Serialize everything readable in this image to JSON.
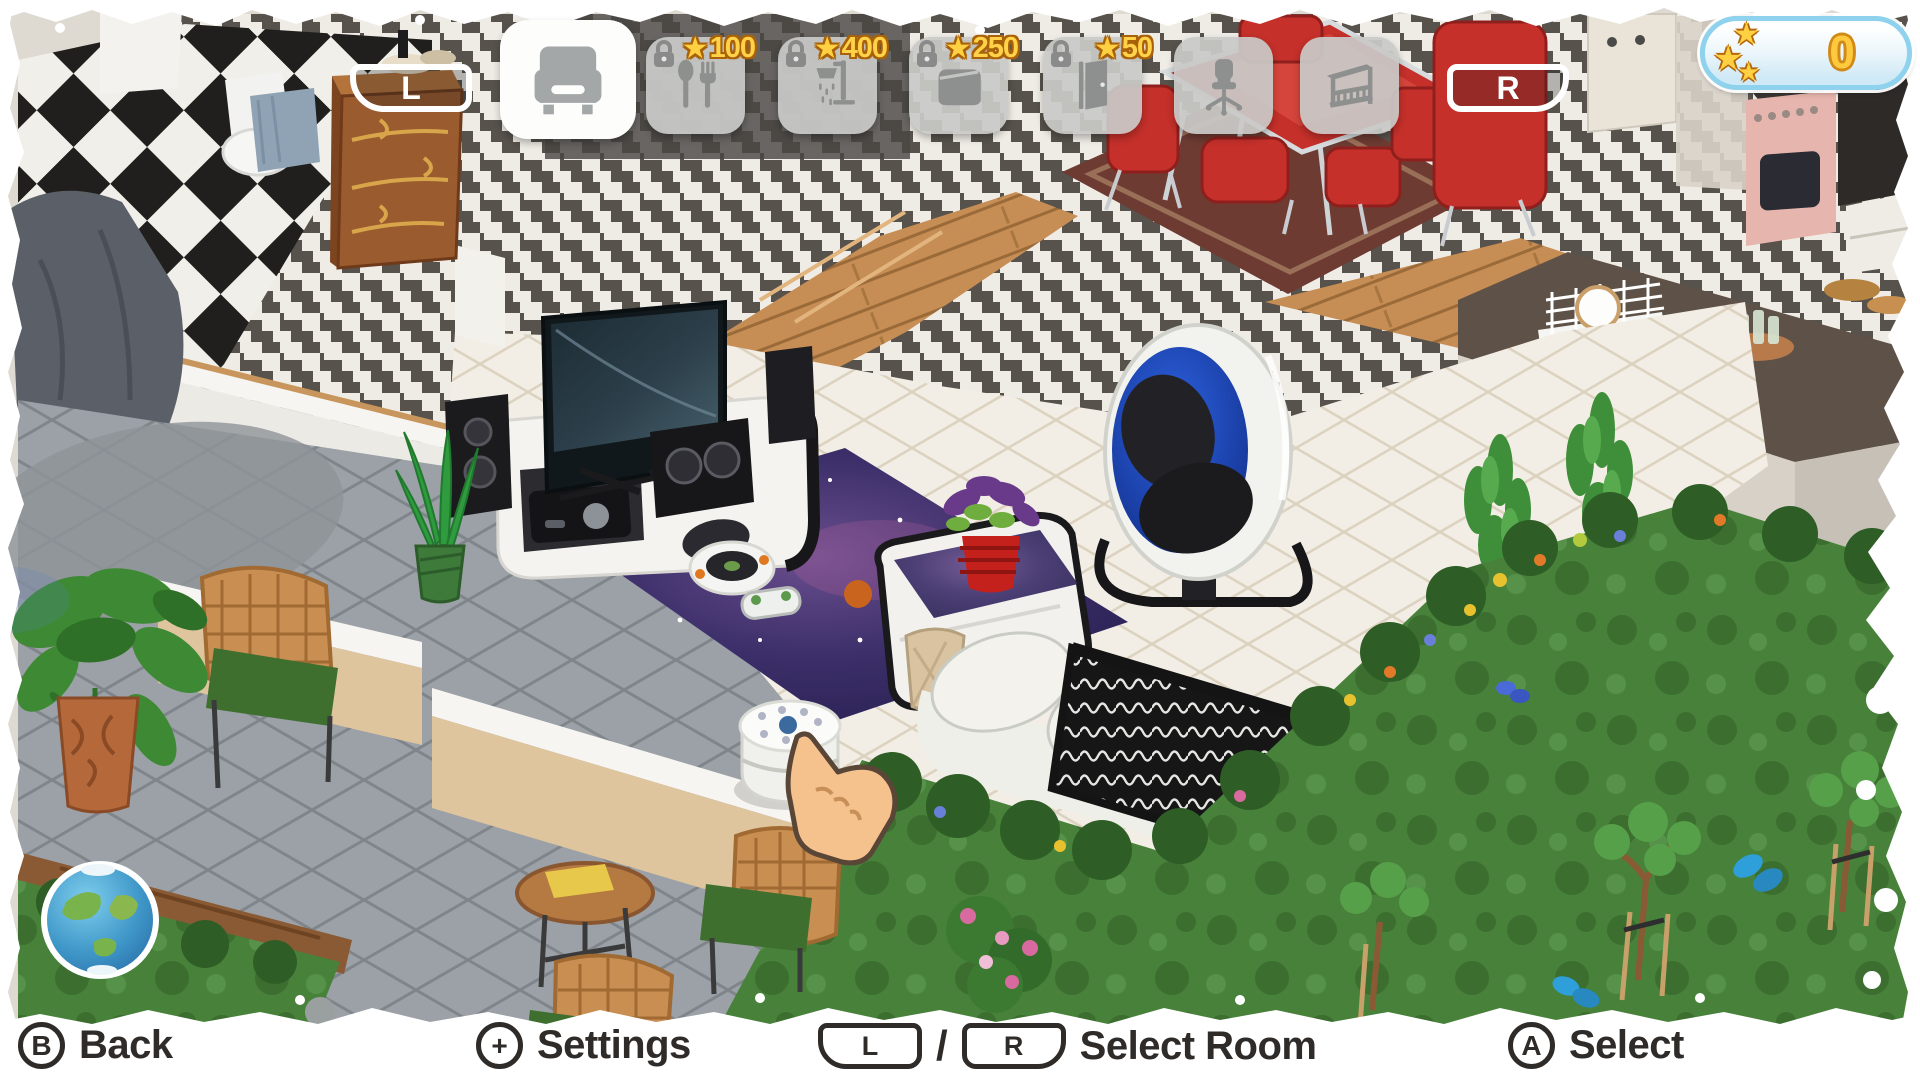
{
  "hud": {
    "left_shoulder": "L",
    "right_shoulder": "R",
    "star_balance": "0",
    "tabs": [
      {
        "name": "living-room",
        "icon": "armchair-icon",
        "selected": true,
        "locked": false,
        "cost": ""
      },
      {
        "name": "dining-room",
        "icon": "cutlery-icon",
        "selected": false,
        "locked": true,
        "cost": "100"
      },
      {
        "name": "bathroom",
        "icon": "shower-icon",
        "selected": false,
        "locked": true,
        "cost": "400"
      },
      {
        "name": "bedroom",
        "icon": "bed-icon",
        "selected": false,
        "locked": true,
        "cost": "250"
      },
      {
        "name": "hallway",
        "icon": "door-icon",
        "selected": false,
        "locked": true,
        "cost": "50"
      },
      {
        "name": "office",
        "icon": "office-chair-icon",
        "selected": false,
        "locked": false,
        "cost": ""
      },
      {
        "name": "balcony",
        "icon": "balcony-icon",
        "selected": false,
        "locked": false,
        "cost": ""
      }
    ]
  },
  "bottom_bar": {
    "back": {
      "button": "B",
      "label": "Back"
    },
    "settings": {
      "button": "+",
      "label": "Settings"
    },
    "select_room": {
      "left_button": "L",
      "separator": "/",
      "right_button": "R",
      "label": "Select Room"
    },
    "select": {
      "button": "A",
      "label": "Select"
    }
  },
  "colors": {
    "chevron_dark": "#57524c",
    "chevron_light": "#efece6",
    "marble": "#f2eee5",
    "patio": "#9ba1a6",
    "grass": "#47813a",
    "accent_red": "#c5302a",
    "star_gold": "#ffd042",
    "pill_border": "#8ed2ee",
    "tan_wall": "#dfc59e",
    "galaxy": "#352a5e",
    "egg_blue": "#1f4fd8"
  }
}
